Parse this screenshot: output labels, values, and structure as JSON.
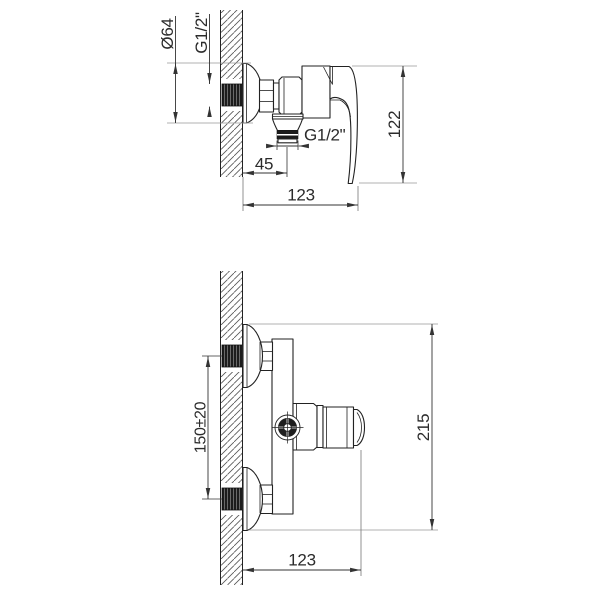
{
  "drawing": {
    "background_color": "#ffffff",
    "line_color": "#222222",
    "dimension_color": "#333333"
  },
  "side_view": {
    "dims": {
      "escutcheon_diameter": "Ø64",
      "wall_inlet_thread": "G1/2\"",
      "body_height": "122",
      "shower_outlet_thread": "G1/2\"",
      "outlet_offset_from_wall": "45",
      "overall_depth": "123"
    }
  },
  "front_view": {
    "dims": {
      "inlet_centres_spacing": "150±20",
      "overall_height": "215",
      "overall_depth": "123"
    }
  }
}
